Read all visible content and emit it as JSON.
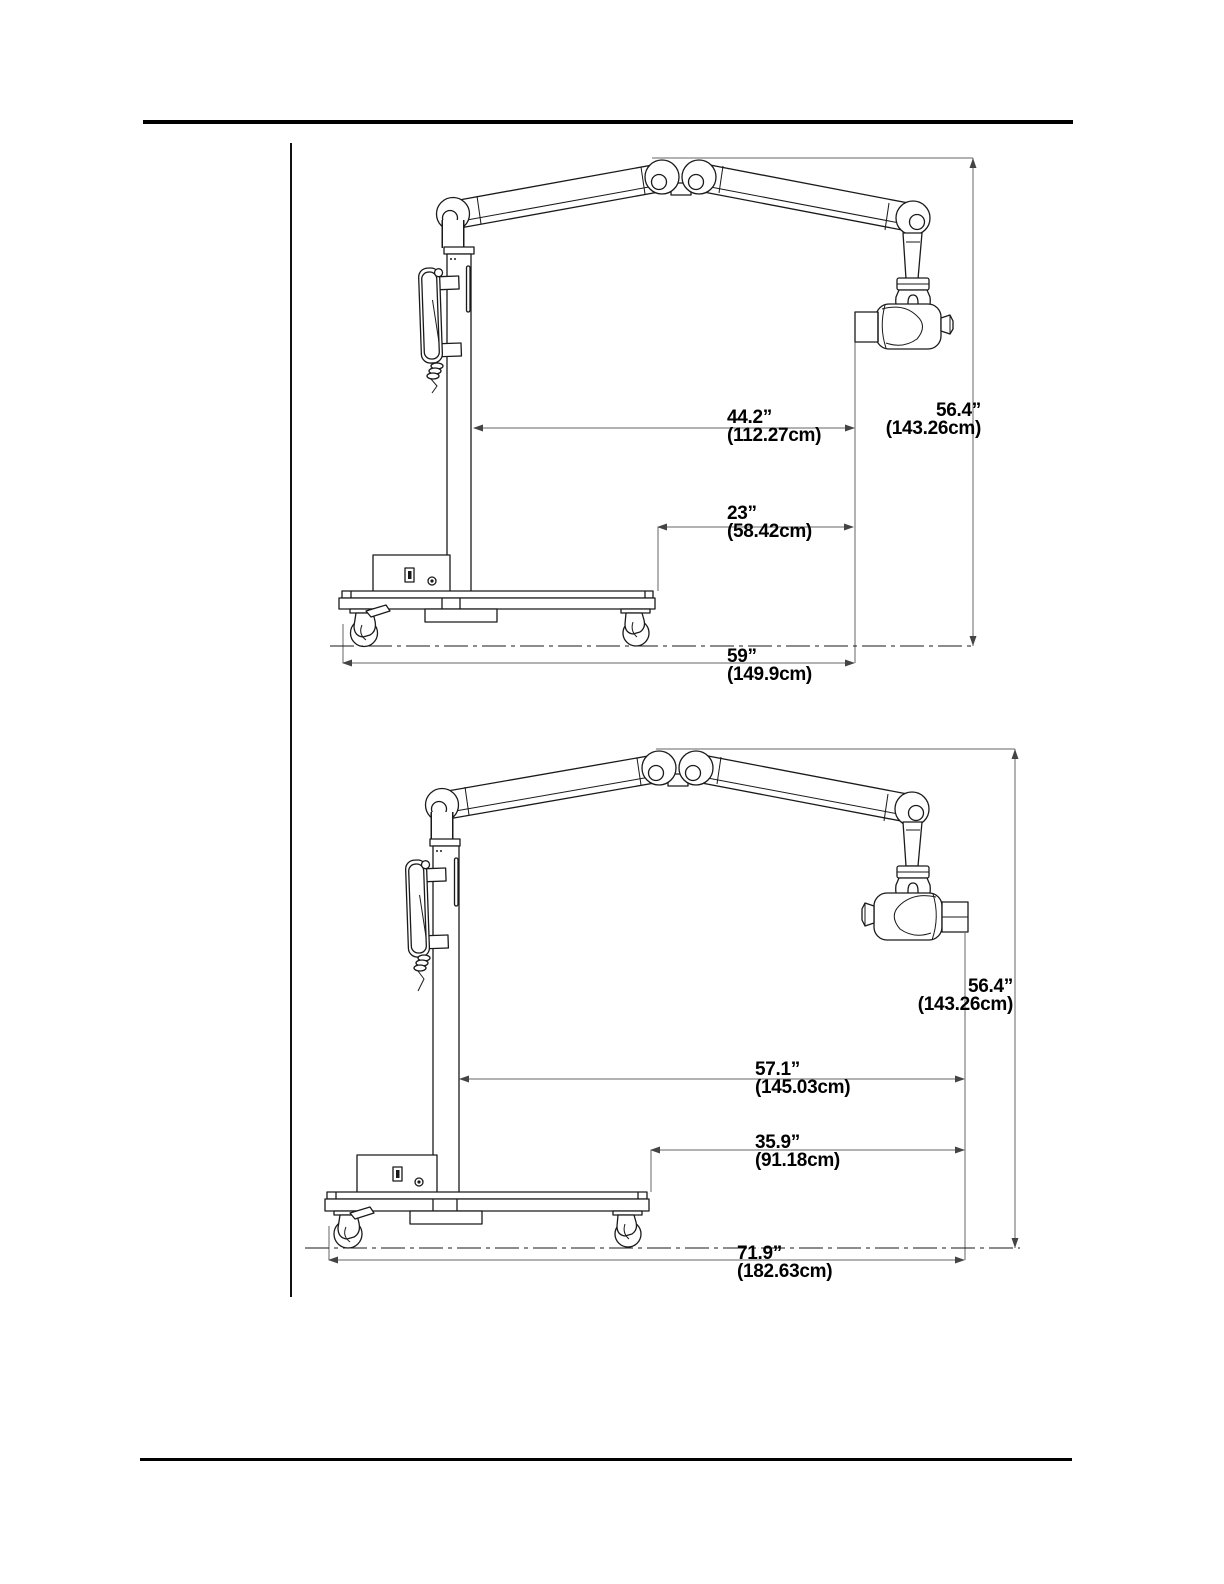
{
  "figures": [
    {
      "id": "top",
      "dims": [
        {
          "in": "44.2”",
          "cm": "(112.27cm)"
        },
        {
          "in": "56.4”",
          "cm": "(143.26cm)"
        },
        {
          "in": "23”",
          "cm": "(58.42cm)"
        },
        {
          "in": "59”",
          "cm": "(149.9cm)"
        }
      ]
    },
    {
      "id": "bottom",
      "dims": [
        {
          "in": "56.4”",
          "cm": "(143.26cm)"
        },
        {
          "in": "57.1”",
          "cm": "(145.03cm)"
        },
        {
          "in": "35.9”",
          "cm": "(91.18cm)"
        },
        {
          "in": "71.9”",
          "cm": "(182.63cm)"
        }
      ]
    }
  ]
}
